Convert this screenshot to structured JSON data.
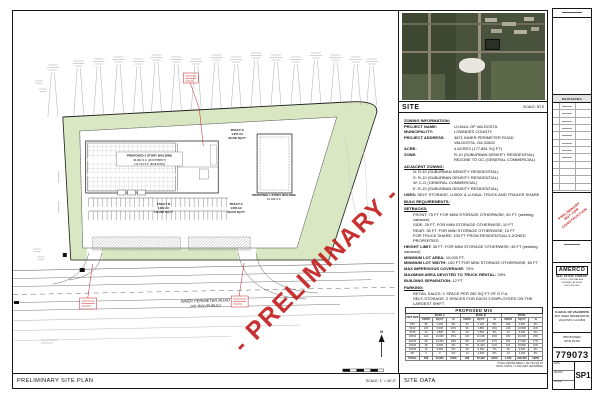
{
  "colors": {
    "watermark_red": "#c42020",
    "site_green": "#d9e8c2",
    "line_dark": "#161616"
  },
  "sheet": {
    "watermark": "- PRELIMINARY -",
    "bottom_bar": {
      "left_title": "PRELIMINARY SITE PLAN",
      "scale": "SCALE: 1\" = 40'-0\"",
      "right_title": "SITE DATA"
    }
  },
  "plan": {
    "road_label_1": "INNER PERIMETER ROAD",
    "road_label_2": "200' R/W (PUBLIC)",
    "building_a_l1": "PROPOSED 3 STORY BUILDING",
    "building_a_l2": "36,062 S.F. (FOOTPRINT)",
    "building_a_l3": "111,744 S.F. (BUILDING)",
    "building_b_l1": "PROPOSED 1 STORY BUILDING",
    "building_b_l2": "15,188 S.F.",
    "tract_a_l1": "TRACT A",
    "tract_a_l2": "1.957 AC",
    "tract_a_l3": "85,230 SQ FT",
    "tract_b_l1": "TRACT B",
    "tract_b_l2": "3.382 AC",
    "tract_b_l3": "146,068 SQ FT",
    "tract_c_l1": "TRACT C",
    "tract_c_l2": "1.585 AC",
    "tract_c_l3": "69,076 SQ FT",
    "north": "N"
  },
  "site_panel": {
    "label": "SITE",
    "scale": "SCALE: NTS",
    "zoning": [
      {
        "t": "h",
        "l": "ZONING INFORMATION:"
      },
      {
        "t": "kv",
        "l": "PROJECT NAME:",
        "v": "U-HAUL OF VALDOSTA"
      },
      {
        "t": "kv",
        "l": "MUNICIPALITY:",
        "v": "LOWNDES COUNTY"
      },
      {
        "t": "kv",
        "l": "PROJECT ADDRESS:",
        "v": "3871 INNER PERIMETER ROAD"
      },
      {
        "t": "c",
        "v": "VALDOSTA, GA 31602"
      },
      {
        "t": "kv",
        "l": "ACRE:",
        "v": "4 ACRES (177,861 SQ FT)"
      },
      {
        "t": "kv",
        "l": "ZONE:",
        "v": "R-10 (SUBURBAN DENSITY RESIDENTIAL)"
      },
      {
        "t": "c",
        "v": "REZONE TO GC (GENERAL COMMERCIAL)"
      },
      {
        "t": "h",
        "l": "ADJACENT ZONING:"
      },
      {
        "t": "i",
        "v": "N: R-10 (SUBURBAN DENSITY RESIDENTIAL)"
      },
      {
        "t": "i",
        "v": "S: R-10 (SUBURBAN DENSITY RESIDENTIAL)"
      },
      {
        "t": "i",
        "v": "W: C-G (GENERAL COMMERCIAL)"
      },
      {
        "t": "i",
        "v": "E: R-10 (SUBURBAN DENSITY RESIDENTIAL)"
      },
      {
        "t": "u",
        "l": "USES:",
        "v": "SELF STORAGE, U-BOX & U-HAUL TRUCK AND TRAILER SHARE"
      },
      {
        "t": "h",
        "l": "BULK REQUIREMENTS:"
      },
      {
        "t": "h",
        "l": "SETBACKS:"
      },
      {
        "t": "i",
        "v": "FRONT: 75 FT FOR MINI STORAGE OTHERWISE; 50 FT. (seeking variance)"
      },
      {
        "t": "i",
        "v": "SIDE: 25 FT. FOR MINI STORAGE OTHERWISE; 10 FT"
      },
      {
        "t": "i",
        "v": "REAR: 35 FT. FOR MINI STORAGE OTHERWISE; 10 FT"
      },
      {
        "t": "i",
        "v": "FOR TRUCK SHARE: 100 FT FROM RESIDENTIALLY-ZONED PROPERTIES"
      },
      {
        "t": "u",
        "l": "HEIGHT LIMIT:",
        "v": "35 FT. FOR MINI STORAGE OTHERWISE; 45 FT (seeking variance)"
      },
      {
        "t": "u",
        "l": "MINIMUM LOT AREA:",
        "v": "10,000 FT."
      },
      {
        "t": "u",
        "l": "MINIMUM LOT WIDTH:",
        "v": "100 FT FOR MINI STORAGE OTHERWISE; 60 FT"
      },
      {
        "t": "u",
        "l": "MAX IMPERVIOUS COVERAGE:",
        "v": "70%"
      },
      {
        "t": "u",
        "l": "MAXIMUM AREA DEVOTED TO TRUCK RENTAL:",
        "v": "25%"
      },
      {
        "t": "u",
        "l": "BUILDING SEPARATION:",
        "v": "12 FT."
      },
      {
        "t": "h",
        "l": "PARKING:"
      },
      {
        "t": "i",
        "v": "RETAIL SALES: 1 SPACE PER 250 SQ FT OF G.F.A."
      },
      {
        "t": "i",
        "v": "SELF-STORAGE: 2 SPACES FOR EACH 3 EMPLOYEES ON THE LARGEST SHIFT"
      },
      {
        "t": "i",
        "v": "(2470 SQ FT / 250 SQ FT = 10 SPACES + 4 SPACES = 14 SPACES REQUIRED/PROVIDED)"
      },
      {
        "t": "h",
        "l": "LANDSCAPING:"
      },
      {
        "t": "i",
        "v": "MINIMUM TOTAL GROSS AREA LANDSCAPED: 15%"
      },
      {
        "t": "i",
        "v": "LANDSCAPE BUFFER: 50 FT (REQUIRED WHEN ABUTTING R-10 ZONE)"
      }
    ]
  },
  "mix_table": {
    "title": "PROPOSED MIX",
    "col0": "UNIT SIZE",
    "groups": [
      "BLDG A",
      "BLDG B",
      "TOTAL"
    ],
    "sub": [
      "UNITS",
      "SQ FT",
      "%"
    ],
    "rows": [
      [
        "5X5",
        "96",
        "2,400",
        "9%",
        "84",
        "2,100",
        "8%",
        "180",
        "4,500",
        "9%"
      ],
      [
        "5X10",
        "120",
        "6,000",
        "22%",
        "96",
        "4,800",
        "19%",
        "216",
        "10,800",
        "21%"
      ],
      [
        "5X15",
        "24",
        "1,800",
        "7%",
        "20",
        "1,500",
        "6%",
        "44",
        "3,300",
        "6%"
      ],
      [
        "10X10",
        "140",
        "14,000",
        "26%",
        "120",
        "12,000",
        "24%",
        "260",
        "26,000",
        "25%"
      ],
      [
        "10X15",
        "96",
        "14,400",
        "18%",
        "88",
        "13,200",
        "17%",
        "184",
        "27,600",
        "17%"
      ],
      [
        "10X20",
        "48",
        "9,600",
        "9%",
        "56",
        "11,200",
        "11%",
        "104",
        "20,800",
        "10%"
      ],
      [
        "10X30",
        "12",
        "3,600",
        "4%",
        "18",
        "5,400",
        "7%",
        "30",
        "9,000",
        "6%"
      ],
      [
        "RV",
        "0",
        "0",
        "0%",
        "14",
        "4,200",
        "8%",
        "14",
        "4,200",
        "6%"
      ],
      [
        "TOTAL",
        "536",
        "51,800",
        "100%",
        "496",
        "54,400",
        "100%",
        "1,032",
        "106,200",
        "100%"
      ]
    ],
    "note1": "TOTAL GROSS AREA = 111,744 SQ FT",
    "note2": "TOTAL UNITS = 1,032 (NET LEASABLE)"
  },
  "title_block": {
    "revisions_label": "REVISIONS",
    "stamp_l1": "PRELIMINARY",
    "stamp_l2": "NOT FOR",
    "stamp_l3": "CONSTRUCTION",
    "company": "AMERCO",
    "company_sub": "REAL ESTATE COMPANY",
    "company_addr1": "2727 N. CENTRAL AVE.",
    "company_addr2": "PHOENIX, AZ 85004",
    "company_addr3": "(602) 263-6555",
    "project_l1": "U-HAUL OF VALDOSTA",
    "project_l2": "3871 INNER PERIMETER RD",
    "project_l3": "VALDOSTA, GA 31602",
    "sheet_title_l1": "PROPOSED",
    "sheet_title_l2": "SITE PLAN",
    "project_number": "779073",
    "sheet_number": "SP1",
    "cell_date": "DATE",
    "cell_drawn": "DRAWN",
    "cell_scale": "SCALE"
  }
}
